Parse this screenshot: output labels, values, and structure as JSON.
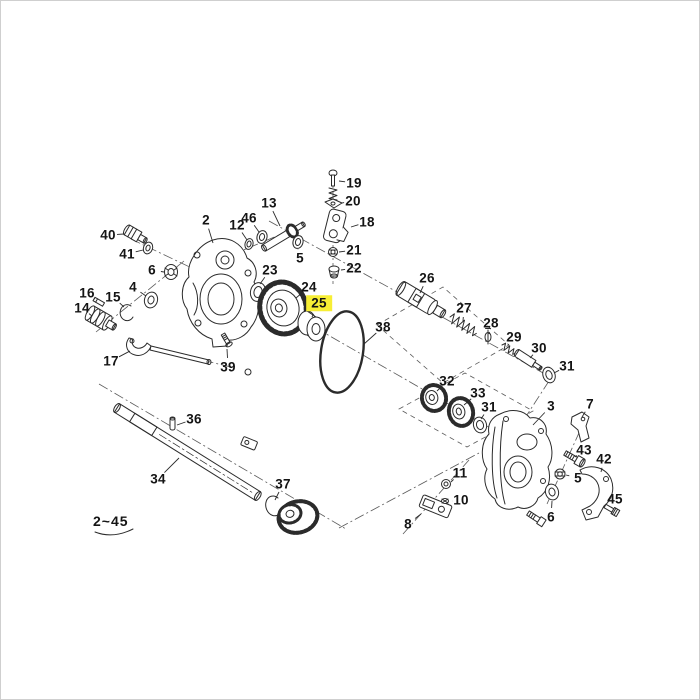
{
  "diagram": {
    "type": "exploded-parts-diagram",
    "background_color": "#ffffff",
    "line_color": "#2b2b2b",
    "highlight_color": "#f7ee35",
    "highlighted_part": "25",
    "range_label": "2~45",
    "labels": [
      {
        "text": "19",
        "x": 353,
        "y": 182,
        "tx": 338,
        "ty": 180
      },
      {
        "text": "20",
        "x": 352,
        "y": 200,
        "tx": 341,
        "ty": 202
      },
      {
        "text": "13",
        "x": 268,
        "y": 202,
        "tx": 279,
        "ty": 225
      },
      {
        "text": "18",
        "x": 366,
        "y": 221,
        "tx": 350,
        "ty": 226
      },
      {
        "text": "2",
        "x": 205,
        "y": 219,
        "tx": 212,
        "ty": 242
      },
      {
        "text": "46",
        "x": 248,
        "y": 217,
        "tx": 258,
        "ty": 231
      },
      {
        "text": "12",
        "x": 236,
        "y": 224,
        "tx": 246,
        "ty": 239
      },
      {
        "text": "40",
        "x": 107,
        "y": 234,
        "tx": 123,
        "ty": 233
      },
      {
        "text": "41",
        "x": 126,
        "y": 253,
        "tx": 142,
        "ty": 249
      },
      {
        "text": "21",
        "x": 353,
        "y": 249,
        "tx": 338,
        "ty": 251
      },
      {
        "text": "5",
        "x": 299,
        "y": 257,
        "tx": 297,
        "ty": 248
      },
      {
        "text": "22",
        "x": 353,
        "y": 267,
        "tx": 340,
        "ty": 269
      },
      {
        "text": "6",
        "x": 151,
        "y": 269,
        "tx": 163,
        "ty": 271
      },
      {
        "text": "23",
        "x": 269,
        "y": 269,
        "tx": 259,
        "ty": 283
      },
      {
        "text": "26",
        "x": 426,
        "y": 277,
        "tx": 419,
        "ty": 292
      },
      {
        "text": "24",
        "x": 308,
        "y": 286,
        "tx": 295,
        "ty": 297
      },
      {
        "text": "4",
        "x": 132,
        "y": 286,
        "tx": 145,
        "ty": 295
      },
      {
        "text": "16",
        "x": 86,
        "y": 292,
        "tx": 94,
        "ty": 298
      },
      {
        "text": "15",
        "x": 112,
        "y": 296,
        "tx": 123,
        "ty": 306
      },
      {
        "text": "25",
        "x": 318,
        "y": 302,
        "tx": 311,
        "ty": 316,
        "highlight": true
      },
      {
        "text": "14",
        "x": 81,
        "y": 307,
        "tx": 91,
        "ty": 315
      },
      {
        "text": "27",
        "x": 463,
        "y": 307,
        "tx": 462,
        "ty": 320
      },
      {
        "text": "28",
        "x": 490,
        "y": 322,
        "tx": 488,
        "ty": 333
      },
      {
        "text": "38",
        "x": 382,
        "y": 326,
        "tx": 363,
        "ty": 343
      },
      {
        "text": "29",
        "x": 513,
        "y": 336,
        "tx": 507,
        "ty": 344
      },
      {
        "text": "30",
        "x": 538,
        "y": 347,
        "tx": 529,
        "ty": 357
      },
      {
        "text": "17",
        "x": 110,
        "y": 360,
        "tx": 129,
        "ty": 350
      },
      {
        "text": "31",
        "x": 566,
        "y": 365,
        "tx": 553,
        "ty": 372
      },
      {
        "text": "39",
        "x": 227,
        "y": 366,
        "tx": 226,
        "ty": 348
      },
      {
        "text": "32",
        "x": 446,
        "y": 380,
        "tx": 436,
        "ty": 390
      },
      {
        "text": "33",
        "x": 477,
        "y": 392,
        "tx": 463,
        "ty": 404
      },
      {
        "text": "7",
        "x": 589,
        "y": 403,
        "tx": 581,
        "ty": 416
      },
      {
        "text": "3",
        "x": 550,
        "y": 405,
        "tx": 532,
        "ty": 424
      },
      {
        "text": "31",
        "x": 488,
        "y": 406,
        "tx": 480,
        "ty": 418
      },
      {
        "text": "36",
        "x": 193,
        "y": 418,
        "tx": 176,
        "ty": 424
      },
      {
        "text": "43",
        "x": 583,
        "y": 449,
        "tx": 574,
        "ty": 456
      },
      {
        "text": "42",
        "x": 603,
        "y": 458,
        "tx": 600,
        "ty": 471
      },
      {
        "text": "11",
        "x": 459,
        "y": 472,
        "tx": 450,
        "ty": 481
      },
      {
        "text": "34",
        "x": 157,
        "y": 478,
        "tx": 178,
        "ty": 457
      },
      {
        "text": "5",
        "x": 577,
        "y": 477,
        "tx": 565,
        "ty": 474
      },
      {
        "text": "37",
        "x": 282,
        "y": 483,
        "tx": 274,
        "ty": 499
      },
      {
        "text": "10",
        "x": 460,
        "y": 499,
        "tx": 451,
        "ty": 500
      },
      {
        "text": "45",
        "x": 614,
        "y": 498,
        "tx": 611,
        "ty": 506
      },
      {
        "text": "6",
        "x": 550,
        "y": 516,
        "tx": 551,
        "ty": 500
      },
      {
        "text": "8",
        "x": 407,
        "y": 523,
        "tx": 420,
        "ty": 513
      }
    ]
  }
}
